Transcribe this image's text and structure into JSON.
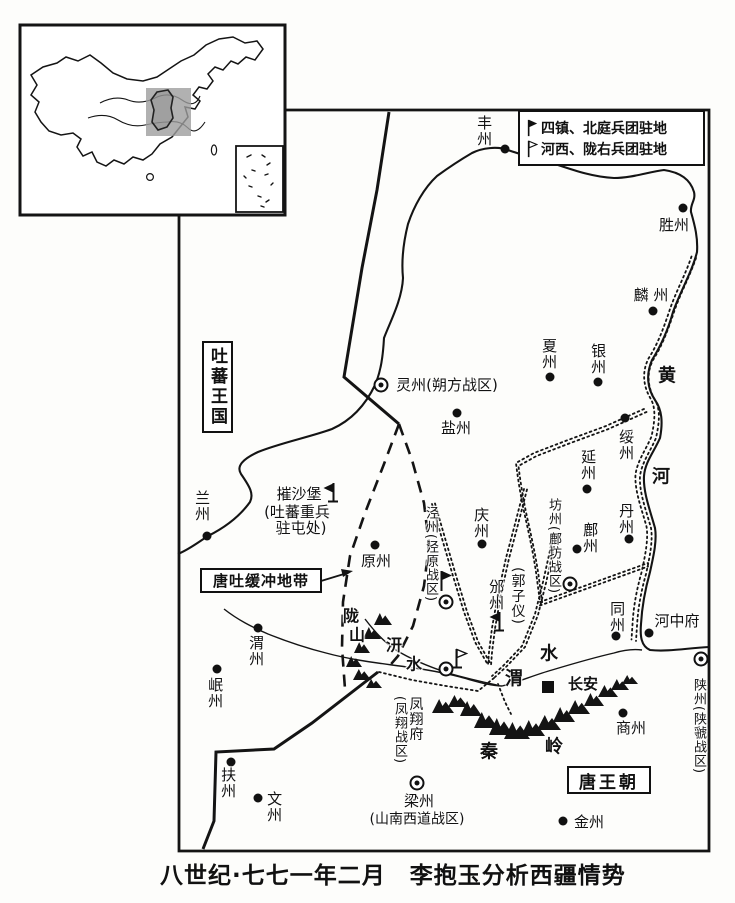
{
  "legend": {
    "items": [
      {
        "flag": "filled",
        "label": "四镇、北庭兵团驻地"
      },
      {
        "flag": "hollow",
        "label": "河西、陇右兵团驻地"
      }
    ]
  },
  "regions": {
    "tibet": "吐蕃王国",
    "buffer_zone": "唐吐缓冲地带",
    "tang": "唐王朝"
  },
  "caption": "八世纪·七七一年二月　李抱玉分析西疆情势",
  "places": [
    {
      "label": "丰州",
      "x": 484,
      "y": 131,
      "o": "v",
      "m": "dot",
      "mx": 505,
      "my": 149
    },
    {
      "label": "胜州",
      "x": 674,
      "y": 225,
      "o": "h",
      "m": "dot",
      "mx": 683,
      "my": 208
    },
    {
      "label": "麟 州",
      "x": 651,
      "y": 295,
      "o": "h",
      "m": "dot",
      "mx": 653,
      "my": 311
    },
    {
      "label": "银州",
      "x": 598,
      "y": 359,
      "o": "v",
      "m": "dot",
      "mx": 598,
      "my": 382
    },
    {
      "label": "夏州",
      "x": 549,
      "y": 354,
      "o": "v",
      "m": "dot",
      "mx": 550,
      "my": 377
    },
    {
      "label": "绥州",
      "x": 626,
      "y": 445,
      "o": "v",
      "m": "dot",
      "mx": 625,
      "my": 418
    },
    {
      "label": "延州",
      "x": 588,
      "y": 465,
      "o": "v",
      "m": "dot",
      "mx": 587,
      "my": 489
    },
    {
      "label": "丹州",
      "x": 626,
      "y": 519,
      "o": "v",
      "m": "dot",
      "mx": 629,
      "my": 539
    },
    {
      "label": "鄜州",
      "x": 590,
      "y": 538,
      "o": "v",
      "m": "dot",
      "mx": 577,
      "my": 549
    },
    {
      "label": "同州",
      "x": 617,
      "y": 617,
      "o": "v",
      "m": "dot",
      "mx": 616,
      "my": 636
    },
    {
      "label": "河中府",
      "x": 677,
      "y": 621,
      "o": "h",
      "m": "dot",
      "mx": 649,
      "my": 633
    },
    {
      "label": "商州",
      "x": 631,
      "y": 728,
      "o": "h",
      "m": "dot",
      "mx": 623,
      "my": 713
    },
    {
      "label": "金州",
      "x": 589,
      "y": 822,
      "o": "h",
      "m": "dot",
      "mx": 563,
      "my": 821
    },
    {
      "label": "兰州",
      "x": 202,
      "y": 506,
      "o": "v",
      "m": "dot",
      "mx": 207,
      "my": 536
    },
    {
      "label": "盐州",
      "x": 456,
      "y": 428,
      "o": "h",
      "m": "dot",
      "mx": 457,
      "my": 413
    },
    {
      "label": "庆州",
      "x": 481,
      "y": 523,
      "o": "v",
      "m": "dot",
      "mx": 482,
      "my": 544
    },
    {
      "label": "原州",
      "x": 376,
      "y": 561,
      "o": "h",
      "m": "dot",
      "mx": 375,
      "my": 545
    },
    {
      "label": "渭州",
      "x": 256,
      "y": 651,
      "o": "v",
      "m": "dot",
      "mx": 258,
      "my": 628
    },
    {
      "label": "岷州",
      "x": 215,
      "y": 693,
      "o": "v",
      "m": "dot",
      "mx": 217,
      "my": 669
    },
    {
      "label": "扶州",
      "x": 228,
      "y": 783,
      "o": "v",
      "m": "dot",
      "mx": 231,
      "my": 762
    },
    {
      "label": "文州",
      "x": 274,
      "y": 807,
      "o": "v",
      "m": "dot",
      "mx": 258,
      "my": 798
    },
    {
      "label": "长安",
      "x": 583,
      "y": 684,
      "o": "h",
      "cls": "strong",
      "m": "square",
      "mx": 548,
      "my": 687
    },
    {
      "label": "灵州(朔方战区)",
      "x": 447,
      "y": 385,
      "o": "h",
      "m": "circled",
      "mx": 381,
      "my": 385
    },
    {
      "label": "泾州(泾原战区)",
      "x": 430,
      "y": 554,
      "o": "v",
      "sz": 13,
      "m": "circled",
      "mx": 446,
      "my": 602,
      "f": "filled-right",
      "fx": 437,
      "fy": 570
    },
    {
      "label": "邠州",
      "x": 496,
      "y": 595,
      "o": "v",
      "f": "filled-left",
      "fx": 488,
      "fy": 611
    },
    {
      "label": "(郭子仪)",
      "x": 517,
      "y": 596,
      "o": "v",
      "sz": 14
    },
    {
      "label": "坊州(鄜坊战区)",
      "x": 553,
      "y": 546,
      "o": "v",
      "sz": 13,
      "m": "circled",
      "mx": 570,
      "my": 584
    },
    {
      "label": "凤翔府",
      "x": 415,
      "y": 719,
      "o": "v",
      "sz": 14,
      "m": "circled",
      "mx": 446,
      "my": 669,
      "f": "hollow-right-base",
      "fx": 452,
      "fy": 648
    },
    {
      "label": "(凤翔战区)",
      "x": 399,
      "y": 730,
      "o": "v",
      "sz": 13
    },
    {
      "label": "梁州",
      "x": 419,
      "y": 801,
      "o": "h",
      "m": "circled",
      "mx": 417,
      "my": 783
    },
    {
      "label": "(山南西道战区)",
      "x": 417,
      "y": 820,
      "o": "h",
      "sz": 14
    },
    {
      "label": "陕州(陕虢战区)",
      "x": 698,
      "y": 726,
      "o": "v",
      "sz": 13,
      "m": "circled",
      "mx": 701,
      "my": 659
    },
    {
      "label": "摧沙堡",
      "x": 299,
      "y": 494,
      "o": "h",
      "f": "filled-left",
      "fx": 322,
      "fy": 482
    },
    {
      "label": "(吐蕃重兵",
      "x": 297,
      "y": 512,
      "o": "h"
    },
    {
      "label": "驻屯处)",
      "x": 301,
      "y": 528,
      "o": "h"
    },
    {
      "label": "黄",
      "x": 667,
      "y": 376,
      "o": "h",
      "cls": "geo"
    },
    {
      "label": "河",
      "x": 661,
      "y": 477,
      "o": "h",
      "cls": "geo"
    },
    {
      "label": "渭",
      "x": 514,
      "y": 679,
      "o": "h",
      "cls": "geo"
    },
    {
      "label": "水",
      "x": 549,
      "y": 654,
      "o": "h",
      "cls": "geo"
    },
    {
      "label": "汧",
      "x": 394,
      "y": 645,
      "o": "h",
      "cls": "geo",
      "sz": 16
    },
    {
      "label": "水",
      "x": 414,
      "y": 664,
      "o": "h",
      "cls": "geo",
      "sz": 16
    },
    {
      "label": "陇",
      "x": 351,
      "y": 616,
      "o": "h",
      "cls": "geo",
      "sz": 16
    },
    {
      "label": "山",
      "x": 357,
      "y": 635,
      "o": "h",
      "cls": "geo",
      "sz": 16
    },
    {
      "label": "秦",
      "x": 489,
      "y": 752,
      "o": "h",
      "cls": "geo"
    },
    {
      "label": "岭",
      "x": 554,
      "y": 747,
      "o": "h",
      "cls": "geo"
    }
  ]
}
